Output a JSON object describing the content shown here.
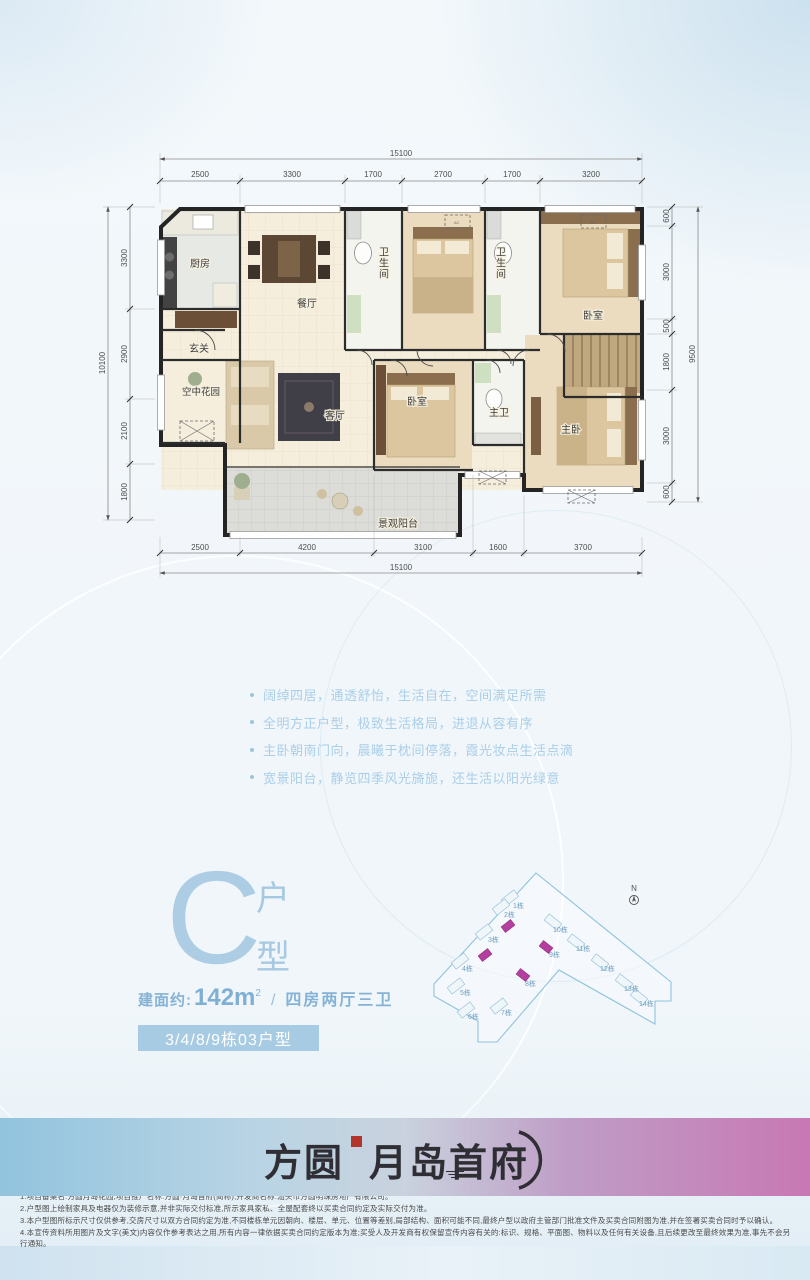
{
  "floorplan": {
    "dims_top": {
      "overall": "15100",
      "segments": [
        "2500",
        "3300",
        "1700",
        "2700",
        "1700",
        "3200"
      ]
    },
    "dims_bottom": {
      "overall": "15100",
      "segments": [
        "2500",
        "4200",
        "3100",
        "1600",
        "3700"
      ]
    },
    "dims_left": {
      "overall": "10100",
      "segments": [
        "3300",
        "2900",
        "2100",
        "1800"
      ]
    },
    "dims_right": {
      "overall": "9500",
      "segments": [
        "600",
        "3000",
        "500",
        "1800",
        "3000",
        "600"
      ]
    },
    "rooms": {
      "kitchen": "厨房",
      "dining": "餐厅",
      "bath1": "卫生间",
      "bath2": "卫生间",
      "bedroom_a": "卧室",
      "entry": "玄关",
      "sky_garden": "空中花园",
      "living": "客厅",
      "bedroom_b": "卧室",
      "master_bath": "主卫",
      "master_bedroom": "主卧",
      "balcony": "景观阳台"
    },
    "ac_label": "AC"
  },
  "features": [
    "阔绰四居，通透舒怡，生活自在，空间满足所需",
    "全明方正户型，极致生活格局，进退从容有序",
    "主卧朝南门向，晨曦于枕间停落，霞光妆点生活点滴",
    "宽景阳台，静览四季风光旖旎，还生活以阳光绿意"
  ],
  "unit": {
    "letter": "C",
    "type_char_1": "户",
    "type_char_2": "型",
    "area_prefix": "建面约:",
    "area_value": "142m",
    "area_sup": "2",
    "slash": "/",
    "layout": "四房两厅三卫",
    "badge": "3/4/8/9栋03户型"
  },
  "siteplan": {
    "north": "N",
    "buildings": [
      "1栋",
      "2栋",
      "3栋",
      "4栋",
      "5栋",
      "6栋",
      "7栋",
      "8栋",
      "9栋",
      "10栋",
      "11栋",
      "12栋",
      "13栋",
      "14栋"
    ],
    "highlight_color": "#b53f9e",
    "outline_color": "#8fc3dd"
  },
  "logo": {
    "brand": "方圆",
    "name": "月岛首府"
  },
  "disclaimer": {
    "lines": [
      "1.项目备案名:方圆月岛花园,项目推广名称:方圆·月岛首府(简称),开发商名称:汕头市方圆明珠房地产有限公司。",
      "2.户型图上绘制家具及电器仅为装修示意,并非实际交付标准,所示家具家私、全屋配套终以买卖合同约定及实际交付为准。",
      "3.本户型图所标示尺寸仅供参考,交房尺寸以双方合同约定为准,不同楼栋单元因朝向、楼层、单元、位置等差别,局部结构、面积可能不同,最终户型以政府主管部门批准文件及买卖合同附图为准,并在签署买卖合同时予以确认。",
      "4.本宣传资料所用图片及文字(美文)内容仅作参考表达之用,所有内容一律依据买卖合同约定版本为准;买受人及开发商有权保留宣传内容有关的:标识、规格、平面图、物料以及任何有关设备,且后续更改至最终效果为准,事先不会另行通知。"
    ]
  }
}
